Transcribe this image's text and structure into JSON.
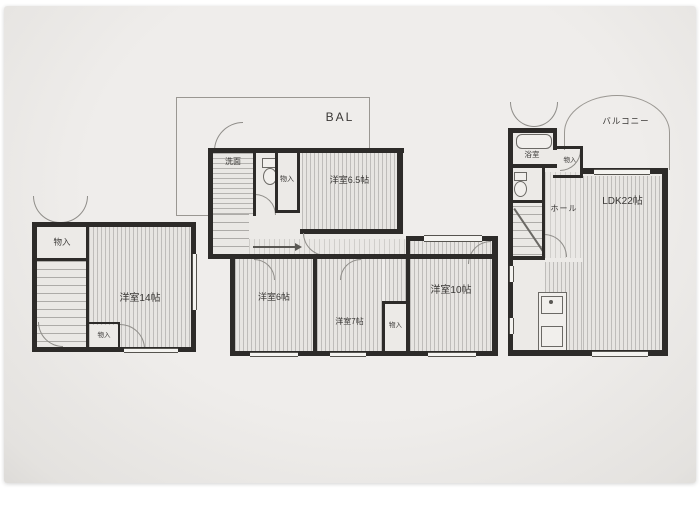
{
  "meta": {
    "kind": "floor-plan-photo"
  },
  "colors": {
    "paper": "#eceae7",
    "wall": "#2d2b29",
    "thin_line": "#9a9792",
    "text": "#3a3836"
  },
  "labels": {
    "left_wing": {
      "closet_top": "物入",
      "room_14": "洋室14帖",
      "closet_bottom": "物入"
    },
    "center_wing": {
      "balcony": "BAL",
      "washroom": "洗面",
      "closet_upper": "物入",
      "room_6_5": "洋室6.5帖",
      "room_6": "洋室6帖",
      "room_7": "洋室7帖",
      "closet_lower": "物入",
      "room_10": "洋室10帖"
    },
    "right_wing": {
      "balcony": "バルコニー",
      "bath": "浴室",
      "closet": "物入",
      "hall": "ホール",
      "ldk": "LDK22帖"
    }
  }
}
